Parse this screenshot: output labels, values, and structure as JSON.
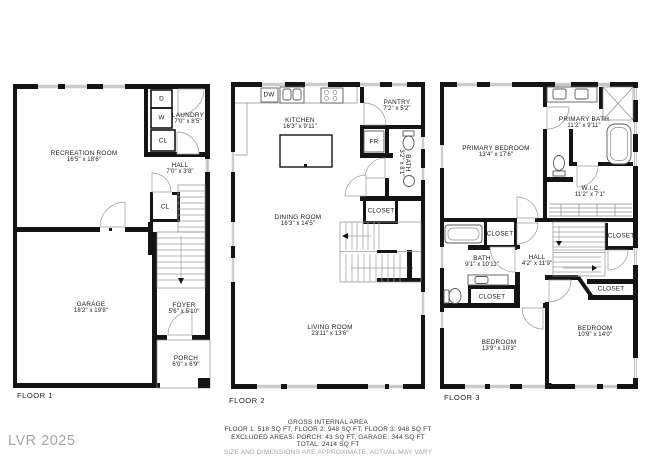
{
  "floors": [
    {
      "label": "FLOOR 1",
      "rooms": [
        {
          "name": "RECREATION ROOM",
          "dims": "16'5\" x 18'6\""
        },
        {
          "name": "LAUNDRY",
          "dims": "7'0\" x 8'5\""
        },
        {
          "name": "HALL",
          "dims": "7'0\" x 3'8\""
        },
        {
          "name": "GARAGE",
          "dims": "18'2\" x 19'8\""
        },
        {
          "name": "FOYER",
          "dims": "5'6\" x 5'10\""
        },
        {
          "name": "PORCH",
          "dims": "6'0\" x 6'9\""
        }
      ],
      "units": {
        "dryer": "D",
        "washer": "W",
        "closet1": "CL",
        "closet2": "CL"
      }
    },
    {
      "label": "FLOOR 2",
      "rooms": [
        {
          "name": "KITCHEN",
          "dims": "16'3\" x 9'11\""
        },
        {
          "name": "PANTRY",
          "dims": "7'2\" x 5'2\""
        },
        {
          "name": "BATH",
          "dims": "3'2\" x 8'1\""
        },
        {
          "name": "DINING ROOM",
          "dims": "16'3\" x 14'5\""
        },
        {
          "name": "LIVING ROOM",
          "dims": "23'11\" x 13'6\""
        }
      ],
      "units": {
        "dishwasher": "DW",
        "fridge": "FR",
        "closet": "CLOSET"
      }
    },
    {
      "label": "FLOOR 3",
      "rooms": [
        {
          "name": "PRIMARY BEDROOM",
          "dims": "13'4\" x 17'6\""
        },
        {
          "name": "PRIMARY BATH",
          "dims": "11'2\" x 9'11\""
        },
        {
          "name": "W.I.C",
          "dims": "11'2\" x 7'1\""
        },
        {
          "name": "BATH",
          "dims": "9'1\" x 10'11\""
        },
        {
          "name": "HALL",
          "dims": "4'2\" x 11'9\""
        },
        {
          "name": "BEDROOM",
          "dims": "13'9\" x 10'3\""
        },
        {
          "name": "BEDROOM",
          "dims": "10'9\" x 14'0\""
        }
      ],
      "units": {
        "closet_a": "CLOSET",
        "closet_b": "CLOSET",
        "closet_c": "CLOSET",
        "closet_d": "CLOSET"
      }
    }
  ],
  "footer": {
    "line1": "GROSS INTERNAL AREA",
    "line2": "FLOOR 1: 518 SQ FT, FLOOR 2: 948 SQ FT, FLOOR 3: 948 SQ FT",
    "line3": "EXCLUDED AREAS: PORCH: 43 SQ FT, GARAGE: 344 SQ FT",
    "line4": "TOTAL: 2414 SQ FT",
    "line5": "SIZE AND DIMENSIONS ARE APPROXIMATE, ACTUAL MAY VARY"
  },
  "watermark": "LVR 2025"
}
